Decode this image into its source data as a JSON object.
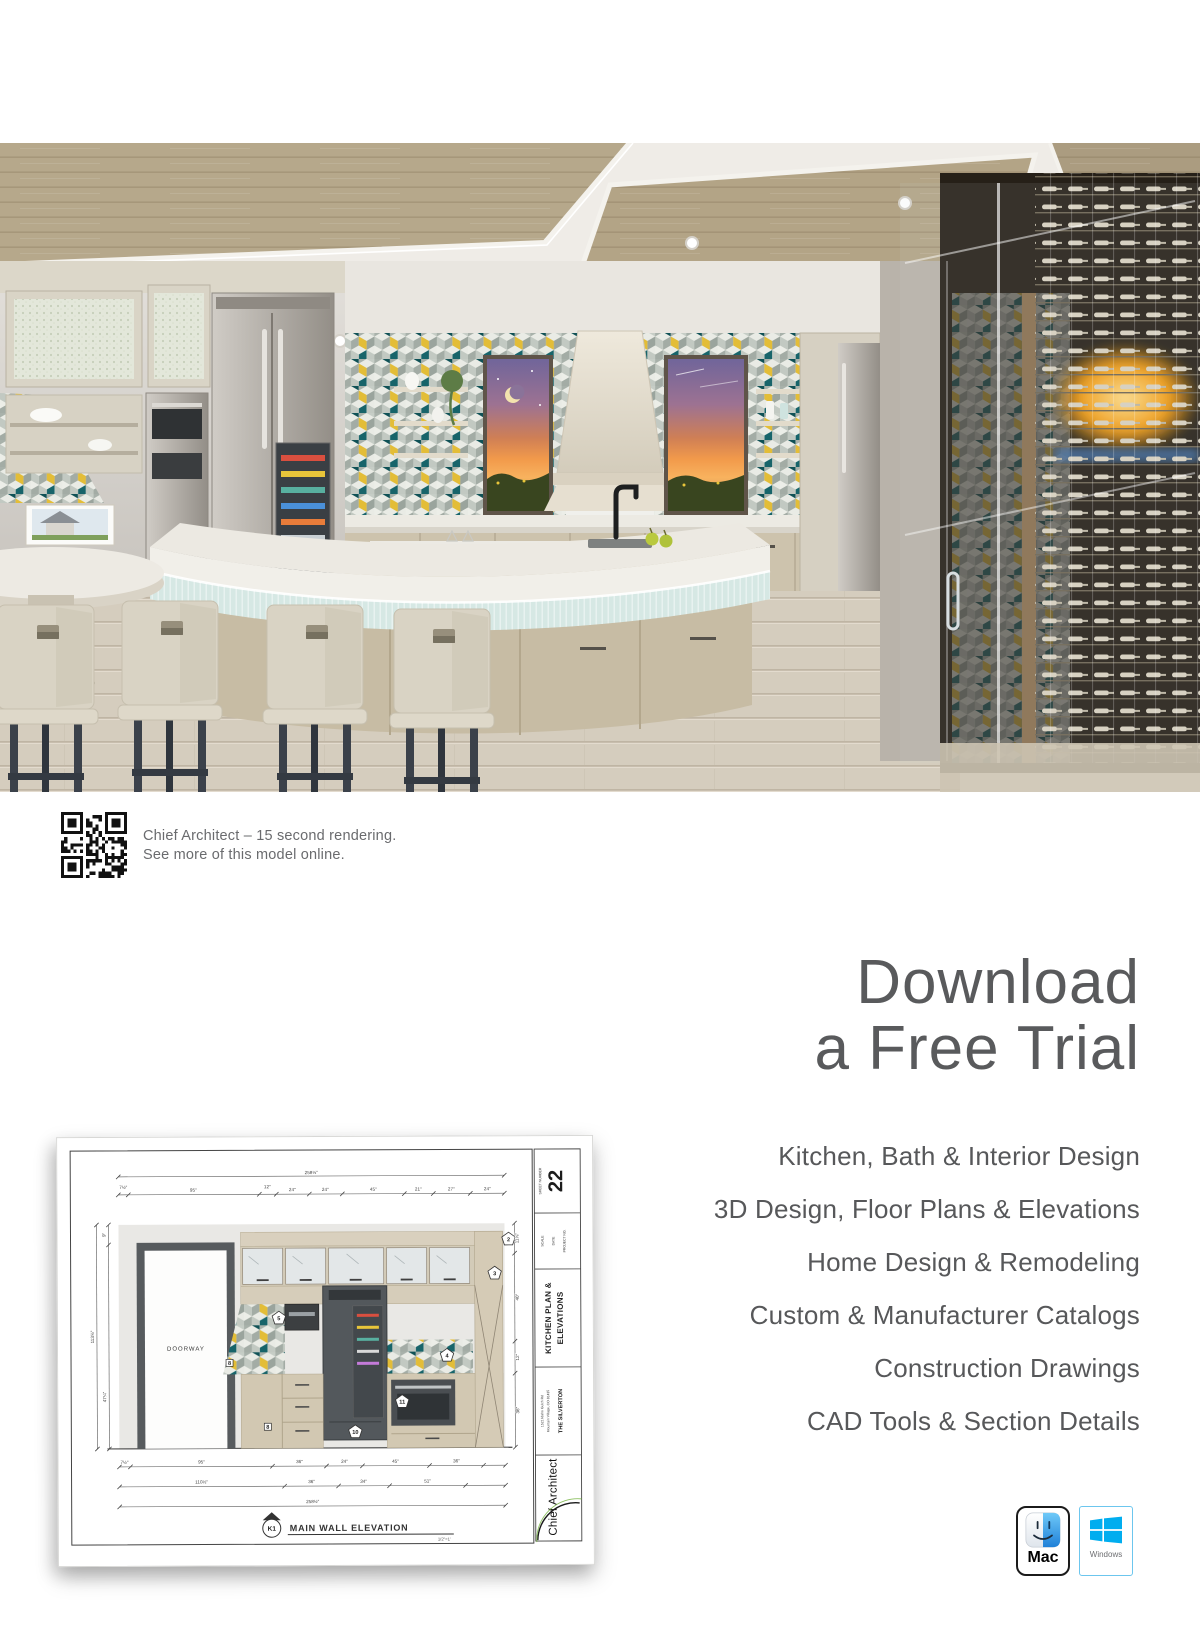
{
  "qr_caption": {
    "line1": "Chief Architect – 15 second rendering.",
    "line2": "See more of this model online."
  },
  "download": {
    "line1": "Download",
    "line2": "a Free Trial"
  },
  "features": {
    "items": [
      "Kitchen, Bath & Interior Design",
      "3D Design, Floor Plans & Elevations",
      "Home Design & Remodeling",
      "Custom & Manufacturer Catalogs",
      "Construction Drawings",
      "CAD Tools & Section Details"
    ]
  },
  "drawing": {
    "sheet_number": "22",
    "sheet_number_label": "SHEET NUMBER",
    "scale_label": "SCALE",
    "date_label": "DATE",
    "project_label": "PROJECT NO.",
    "block_title_line1": "KITCHEN PLAN &",
    "block_title_line2": "ELEVATIONS",
    "address_line1": "1521 Idaho Gulch Rd",
    "address_line2": "Mountain Village, CO 81435",
    "project_name": "THE SILVERTON",
    "brand": "Chief Architect",
    "doorway_label": "DOORWAY",
    "view_ref": "K1",
    "view_title": "MAIN WALL ELEVATION",
    "view_scale": "1/2\"=1'",
    "dims_top_total": "258½\"",
    "dims_top": [
      "7½\"",
      "95\"",
      "12\"",
      "24\"",
      "24\"",
      "45\"",
      "21\"",
      "27\"",
      "24\""
    ],
    "dims_left": [
      "9\"",
      "47¼\"",
      "113⅝\""
    ],
    "dims_right": [
      "11⅝\"",
      "40\"",
      "12\"",
      "36\""
    ],
    "dims_bottom_row1": [
      "7½\"",
      "95\"",
      "36\"",
      "24\"",
      "45\"",
      "36\""
    ],
    "dims_bottom_row2": [
      "110½\"",
      "36\"",
      "34\"",
      "51\""
    ],
    "dims_bottom_total": "258½\"",
    "callouts": [
      "2",
      "3",
      "4",
      "5",
      "8",
      "10",
      "11"
    ]
  },
  "platforms": {
    "mac_label": "Mac",
    "windows_label": "Windows"
  },
  "hero_palette": {
    "tile_teal": "#17646a",
    "tile_yellow": "#e3bd37",
    "ceiling_wood": "#b6a88b",
    "sunset_orange": "#f29a4b",
    "cabinet_cream": "#d9d4c6"
  },
  "brand_colors": {
    "windows_blue": "#00adef",
    "text_gray": "#58595b"
  }
}
